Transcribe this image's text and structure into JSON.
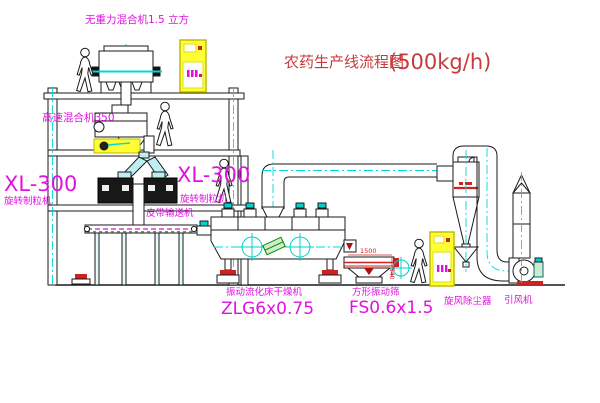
{
  "title": {
    "text": "农药生产线流程图",
    "capacity": "(500kg/h)"
  },
  "labels": {
    "gravity_mixer": "无重力混合机1.5 立方",
    "high_speed_mixer": "高速混合机350",
    "granulator_left": {
      "model": "XL-300",
      "name": "旋转制粒机"
    },
    "granulator_right": {
      "model": "XL-300",
      "name": "旋转制粒机"
    },
    "belt_conveyor": "皮带输送机",
    "dryer": {
      "name": "振动流化床干燥机",
      "model": "ZLG6x0.75"
    },
    "screen": {
      "name": "方形振动筛",
      "model": "FS0.6x1.5"
    },
    "cyclone": "旋风除尘器",
    "induced_draft_fan": "引风机",
    "dim_screen_width": "1500",
    "dim_screen_height": "540"
  },
  "colors": {
    "line_black": "#1a1a1a",
    "label_magenta": "#e012e0",
    "title_red": "#c63c3c",
    "dim_red": "#cc2222",
    "centerline_cyan": "#00d8d8",
    "equipment_yellow": "#ffff33",
    "green": "#009900"
  }
}
